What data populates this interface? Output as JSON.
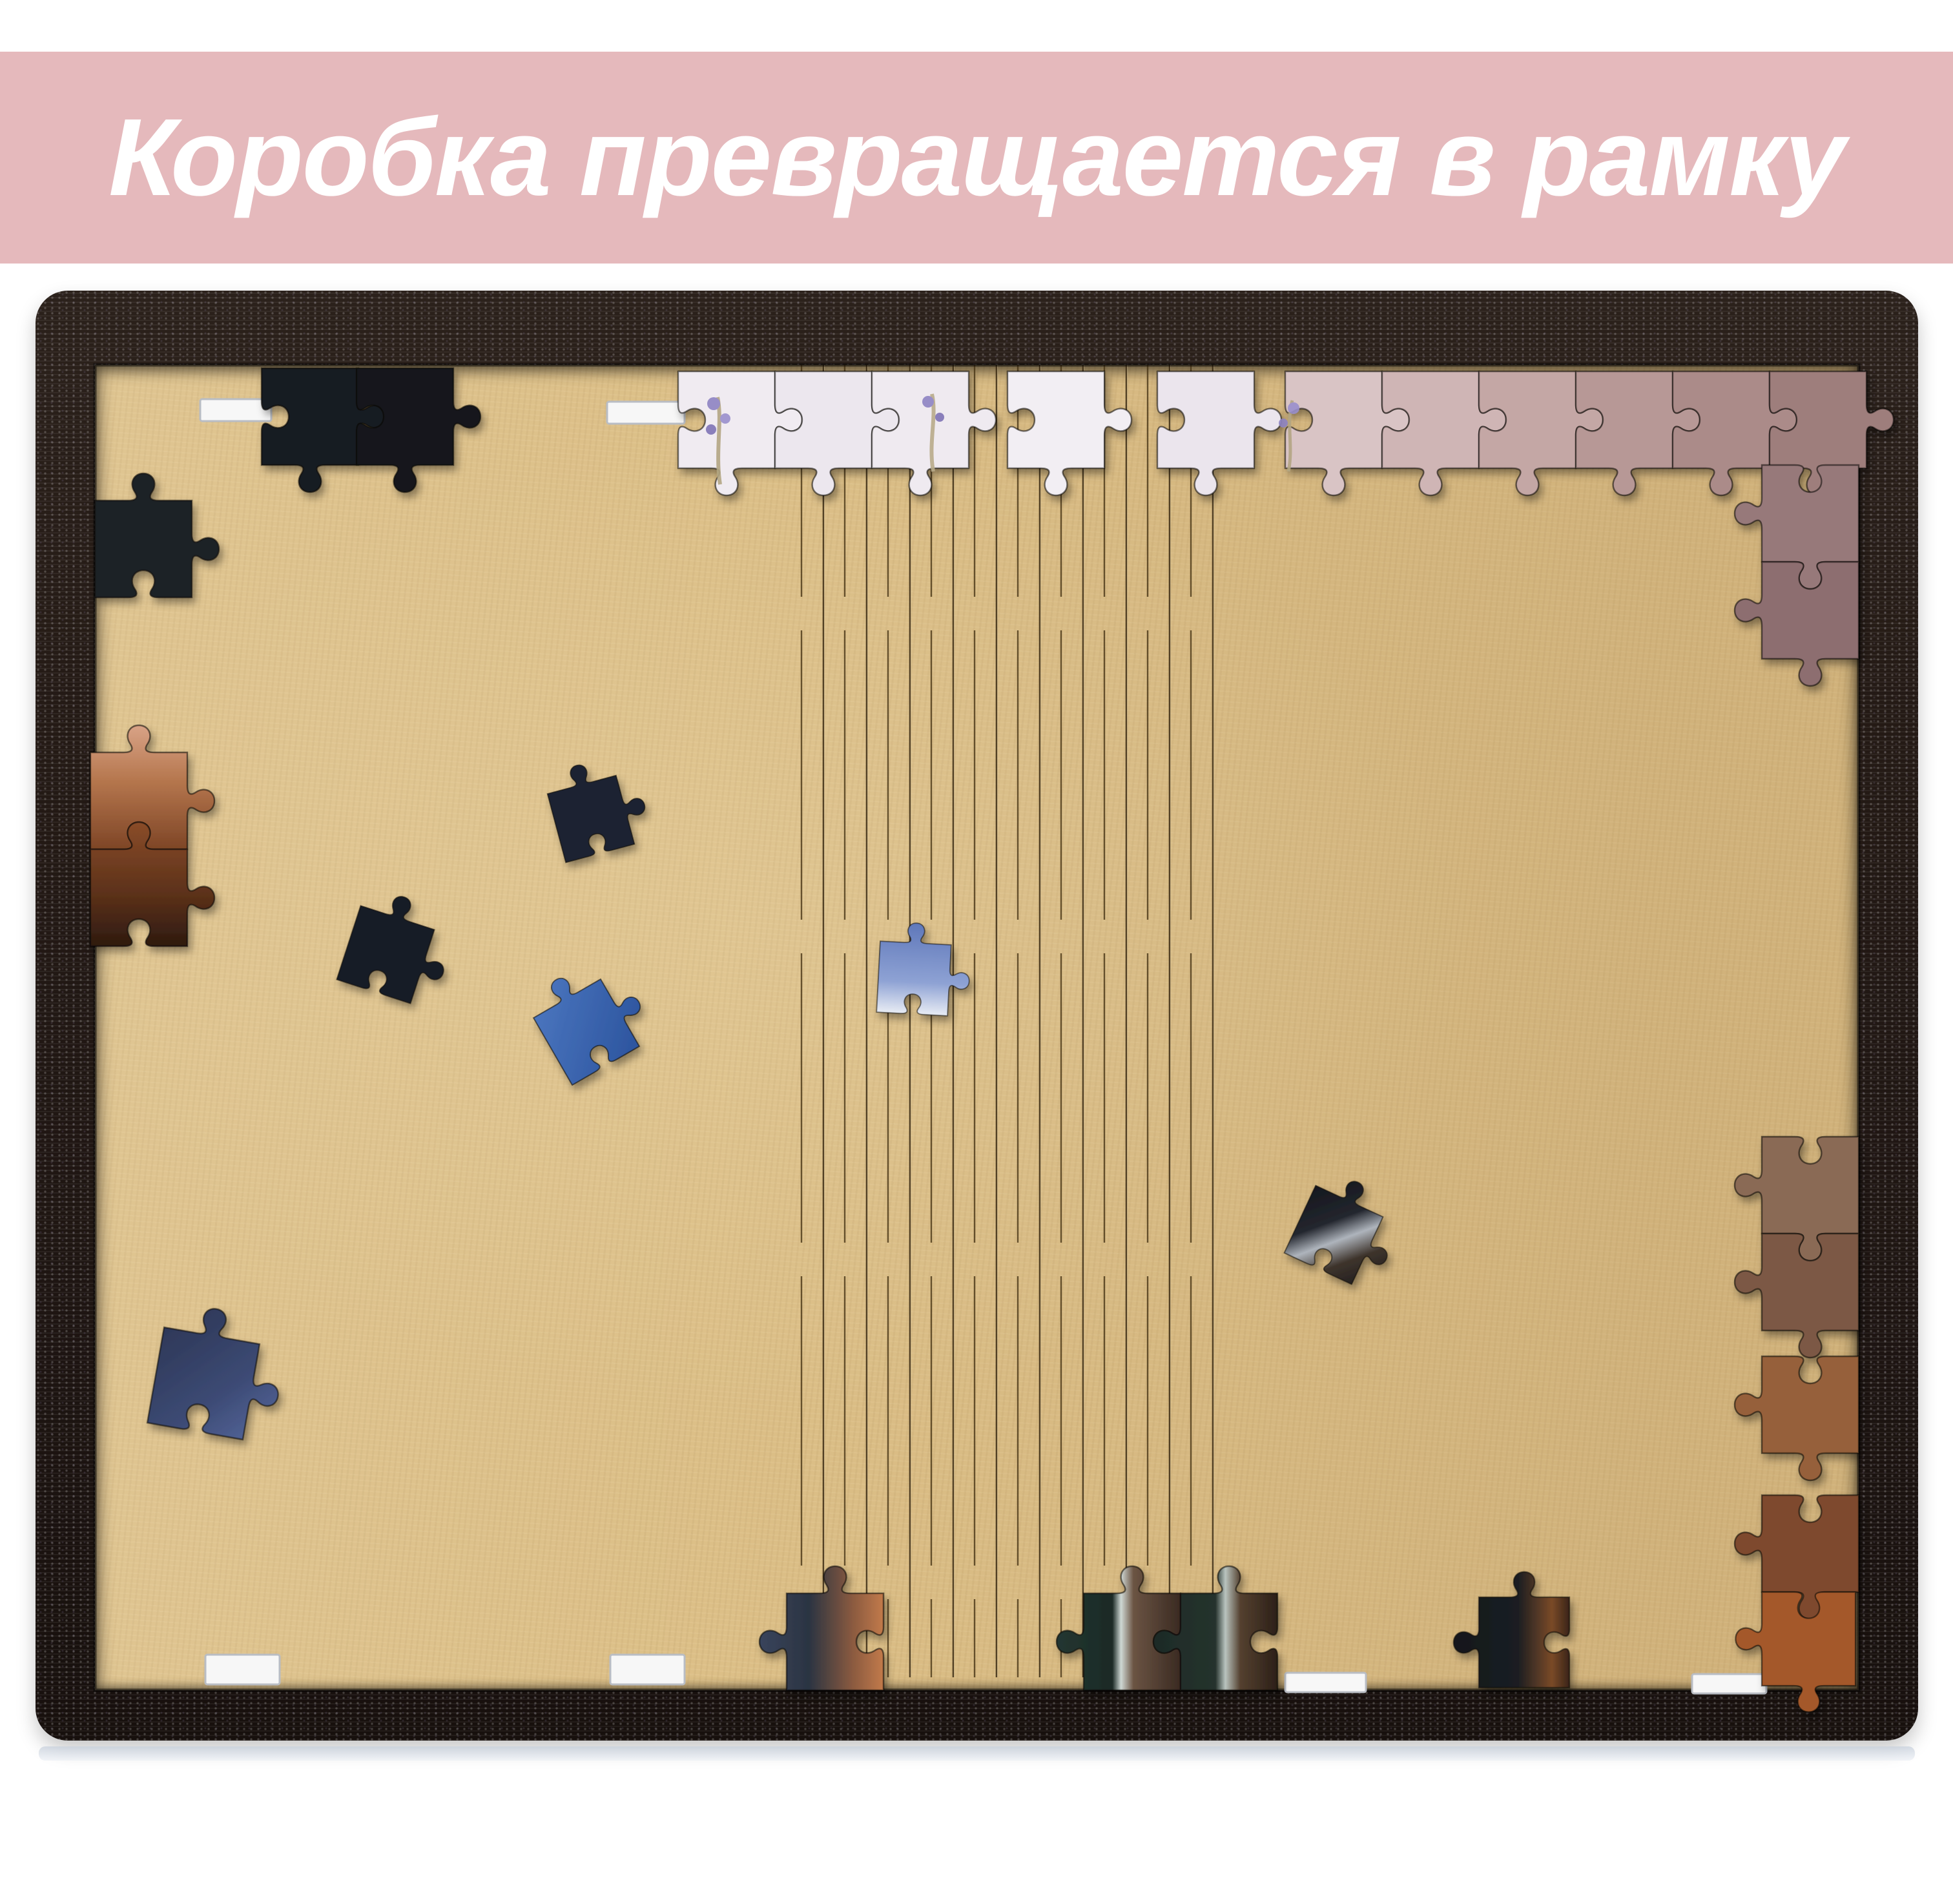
{
  "banner": {
    "text": "Коробка превращается в рамку",
    "background": "#e5b9bc",
    "text_color": "#ffffff"
  },
  "photo": {
    "subject": "puzzle-box-frame-board",
    "colors": {
      "frame_wood": "#241a15",
      "mdf_board": "#dcbf87",
      "kerf_line": "#3a2a12",
      "black_piece": "#14171c",
      "navy_piece": "#1b2130",
      "bright_blue_piece": "#2f58a2",
      "sky_piece": "#8ea2d4",
      "lavender_white_piece": "#f0ebf1",
      "mauve_piece": "#c4a7a5",
      "brown_piece": "#8a6a55",
      "orange_piece": "#a4592b",
      "teal_dark_piece": "#233631",
      "slot_tab": "#f7f7f7"
    }
  }
}
